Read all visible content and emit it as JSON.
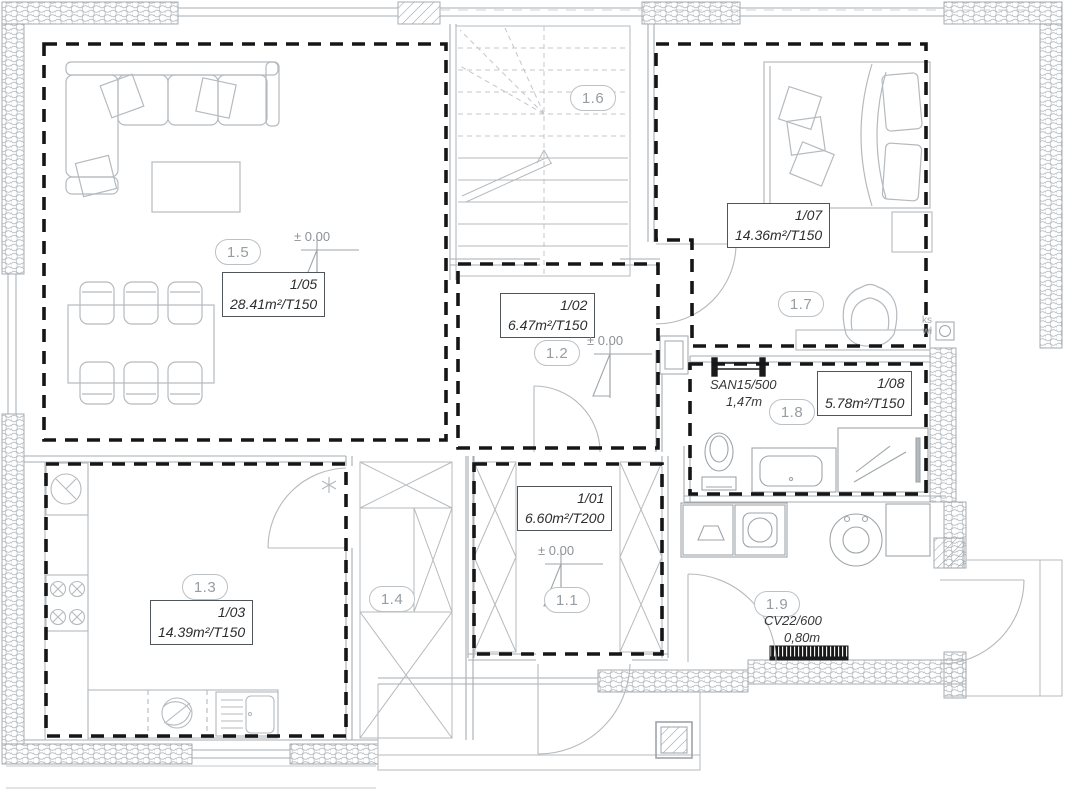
{
  "colors": {
    "wall_line": "#9ea4a8",
    "furniture_line": "#b5babe",
    "zone_dash": "#161616",
    "label_border": "#50555a",
    "bubble_text": "#979da2"
  },
  "rooms": {
    "r11": {
      "bubble": "1.1",
      "tag": "1/01",
      "area": "6.60m²/T200"
    },
    "r12": {
      "bubble": "1.2",
      "tag": "1/02",
      "area": "6.47m²/T150"
    },
    "r13": {
      "bubble": "1.3",
      "tag": "1/03",
      "area": "14.39m²/T150"
    },
    "r14": {
      "bubble": "1.4"
    },
    "r15": {
      "bubble": "1.5",
      "tag": "1/05",
      "area": "28.41m²/T150"
    },
    "r16": {
      "bubble": "1.6"
    },
    "r17": {
      "bubble": "1.7",
      "tag": "1/07",
      "area": "14.36m²/T150"
    },
    "r18": {
      "bubble": "1.8",
      "tag": "1/08",
      "area": "5.78m²/T150"
    },
    "r19": {
      "bubble": "1.9"
    }
  },
  "markers": {
    "elevation": "± 0.00"
  },
  "equipment": {
    "towel_radiator_label": "SAN15/500",
    "towel_radiator_length": "1,47m",
    "radiator_label": "CV22/600",
    "radiator_length": "0,80m",
    "shaft_label_1": "ks",
    "shaft_label_2": "wł"
  }
}
